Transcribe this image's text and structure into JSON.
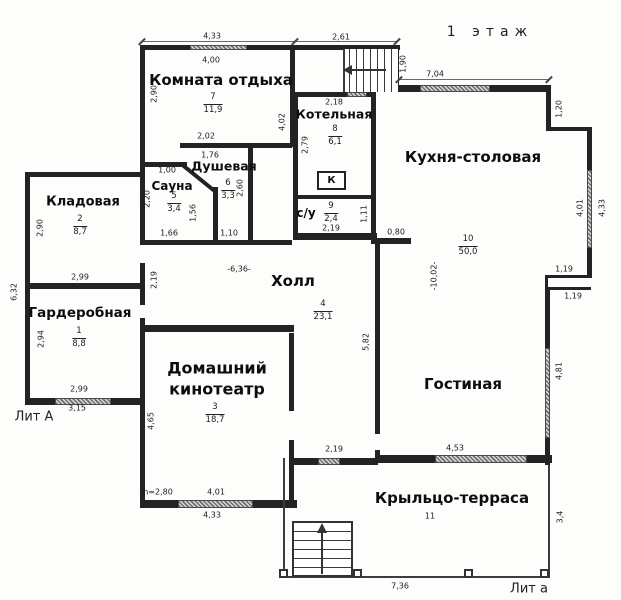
{
  "title": "1 этаж",
  "legend": {
    "lit_main": "Лит А",
    "lit_porch": "Лит а",
    "boiler_mark": "К"
  },
  "rooms": {
    "rest": {
      "label": "Комната отдыха",
      "num": "7",
      "area": "11,9"
    },
    "boiler": {
      "label": "Котельная",
      "num": "8",
      "area": "6,1"
    },
    "kitchen": {
      "label": "Кухня-столовая",
      "num": "10",
      "area": "50,0"
    },
    "shower": {
      "label": "Душевая",
      "num": "6",
      "area": "3,3"
    },
    "sauna": {
      "label": "Сауна",
      "num": "5",
      "area": "3,4"
    },
    "storage": {
      "label": "Кладовая",
      "num": "2",
      "area": "8,7"
    },
    "wc": {
      "label": "с/у",
      "num": "9",
      "area": "2,4"
    },
    "wardrobe": {
      "label": "Гардеробная",
      "num": "1",
      "area": "8,8"
    },
    "hall": {
      "label": "Холл",
      "num": "4",
      "area": "23,1"
    },
    "cinema": {
      "label_line1": "Домашний",
      "label_line2": "кинотеатр",
      "num": "3",
      "area": "18,7"
    },
    "living": {
      "label": "Гостиная"
    },
    "porch": {
      "label": "Крыльцо-терраса",
      "num": "11"
    }
  },
  "dims": {
    "rest_top_out": "4,33",
    "rest_top_in": "4,00",
    "stairs_top": "2,61",
    "stairs_height": "1,90",
    "kitchen_top": "7,04",
    "kitchen_step": "1,20",
    "rest_left": "2,90",
    "hall_upper_left": "4,02",
    "boiler_top": "2,18",
    "boiler_left": "2,79",
    "shower_top_out": "2,02",
    "shower_top_in": "1,76",
    "sauna_top": "1,00",
    "sauna_left": "2,20",
    "sauna_right": "1,56",
    "shower_right": "2,60",
    "sauna_bottom": "1,66",
    "shower_bottom": "1,10",
    "storage_left": "2,90",
    "storage_bottom": "2,99",
    "annex_left": "6,32",
    "wardrobe_left": "2,94",
    "wardrobe_bottom": "2,99",
    "wardrobe_bottom_out": "3,15",
    "hall_left": "2,19",
    "hall_width": "-6,36-",
    "hall_right": "5,82",
    "kitchen_stub": "0,80",
    "wc_bottom": "2,19",
    "wc_right": "1,11",
    "kitchen_right_in": "4,01",
    "kitchen_right_out": "4,33",
    "kitchen_step1": "1,19",
    "kitchen_step2": "1,19",
    "kitchen_depth": "-10,02-",
    "living_right": "4,81",
    "living_bottom": "4,53",
    "hall_porch": "2,19",
    "cinema_left": "4,65",
    "cinema_height": "h=2,80",
    "cinema_bottom_in": "4,01",
    "cinema_bottom_out": "4,33",
    "porch_bottom": "7,36",
    "porch_right": "3,4"
  }
}
